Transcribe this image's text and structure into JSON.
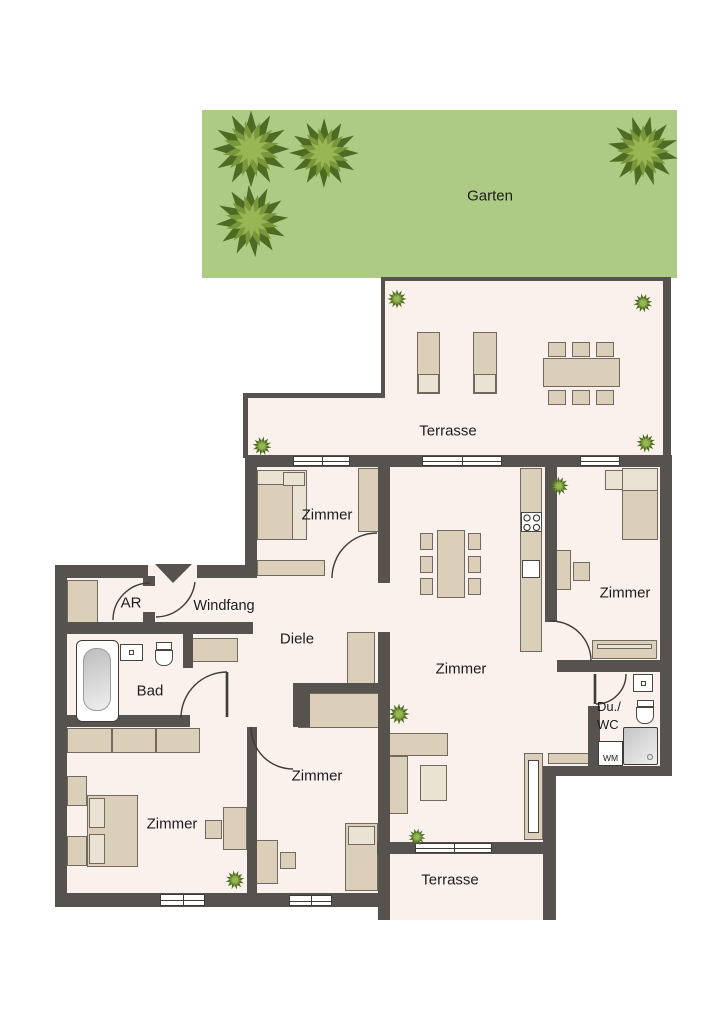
{
  "plan_type": "apartment floor plan (top view)",
  "labels": {
    "garden": "Garten",
    "terrace_top": "Terrasse",
    "terrace_bottom": "Terrasse",
    "room_zimmer": "Zimmer",
    "windfang": "Windfang",
    "diele": "Diele",
    "bad": "Bad",
    "ar": "AR",
    "du_wc_line1": "Du./",
    "du_wc_line2": "WC",
    "wm": "WM"
  },
  "rooms_visible": [
    "Garten",
    "Terrasse",
    "Zimmer",
    "Zimmer",
    "Zimmer",
    "Zimmer",
    "Zimmer",
    "Windfang",
    "Diele",
    "AR",
    "Bad",
    "Du./WC",
    "Terrasse"
  ],
  "palette": {
    "wall": "#56524d",
    "floor": "#faf1ed",
    "garden_green": "#aecb85",
    "furniture_beige": "#dccfb9",
    "furniture_light": "#eae2d3",
    "bush_dark": "#4e6b24",
    "bush_mid": "#79983b",
    "bush_light": "#97b654",
    "text": "#1c1c1c"
  }
}
